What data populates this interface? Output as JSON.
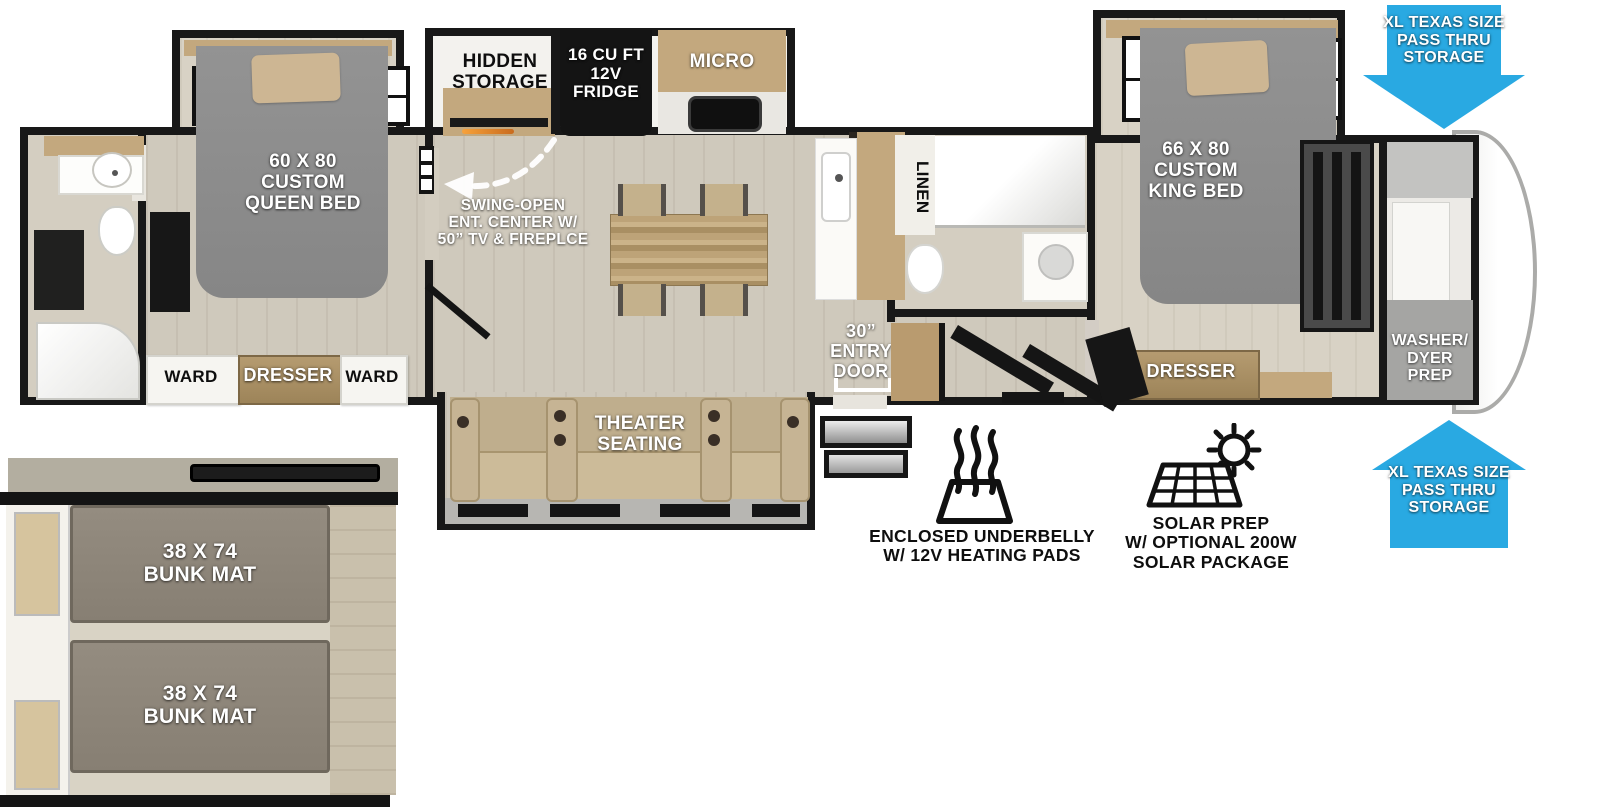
{
  "colors": {
    "accent_blue": "#29a9e2",
    "wall_black": "#181818",
    "bed_gray": "#8c8c8c",
    "cabinet_wood": "#c3a87e",
    "dresser_brown": "#a78e63",
    "floor_tan": "#cfc9bc"
  },
  "labels": {
    "queen_bed": "60 X 80\nCUSTOM\nQUEEN BED",
    "ward_left": "WARD",
    "dresser_queen": "DRESSER",
    "ward_right": "WARD",
    "hidden_storage": "HIDDEN\nSTORAGE",
    "fridge": "16 CU FT\n12V\nFRIDGE",
    "micro": "MICRO",
    "ent_center": "SWING-OPEN\nENT. CENTER W/\n50” TV & FIREPLCE",
    "theater": "THEATER\nSEATING",
    "entry_door": "30”\nENTRY\nDOOR",
    "linen": "LINEN",
    "king_bed": "66 X 80\nCUSTOM\nKING BED",
    "dresser_king": "DRESSER",
    "washer_dryer": "WASHER/\nDYER\nPREP",
    "bunk_top": "38 X 74\nBUNK MAT",
    "bunk_bottom": "38 X 74\nBUNK MAT",
    "storage_callout_top": "XL TEXAS SIZE\nPASS THRU\nSTORAGE",
    "storage_callout_bottom": "XL TEXAS SIZE\nPASS THRU\nSTORAGE",
    "underbelly": "ENCLOSED UNDERBELLY\nW/ 12V HEATING PADS",
    "solar": "SOLAR PREP\nW/ OPTIONAL 200W\nSOLAR PACKAGE"
  }
}
